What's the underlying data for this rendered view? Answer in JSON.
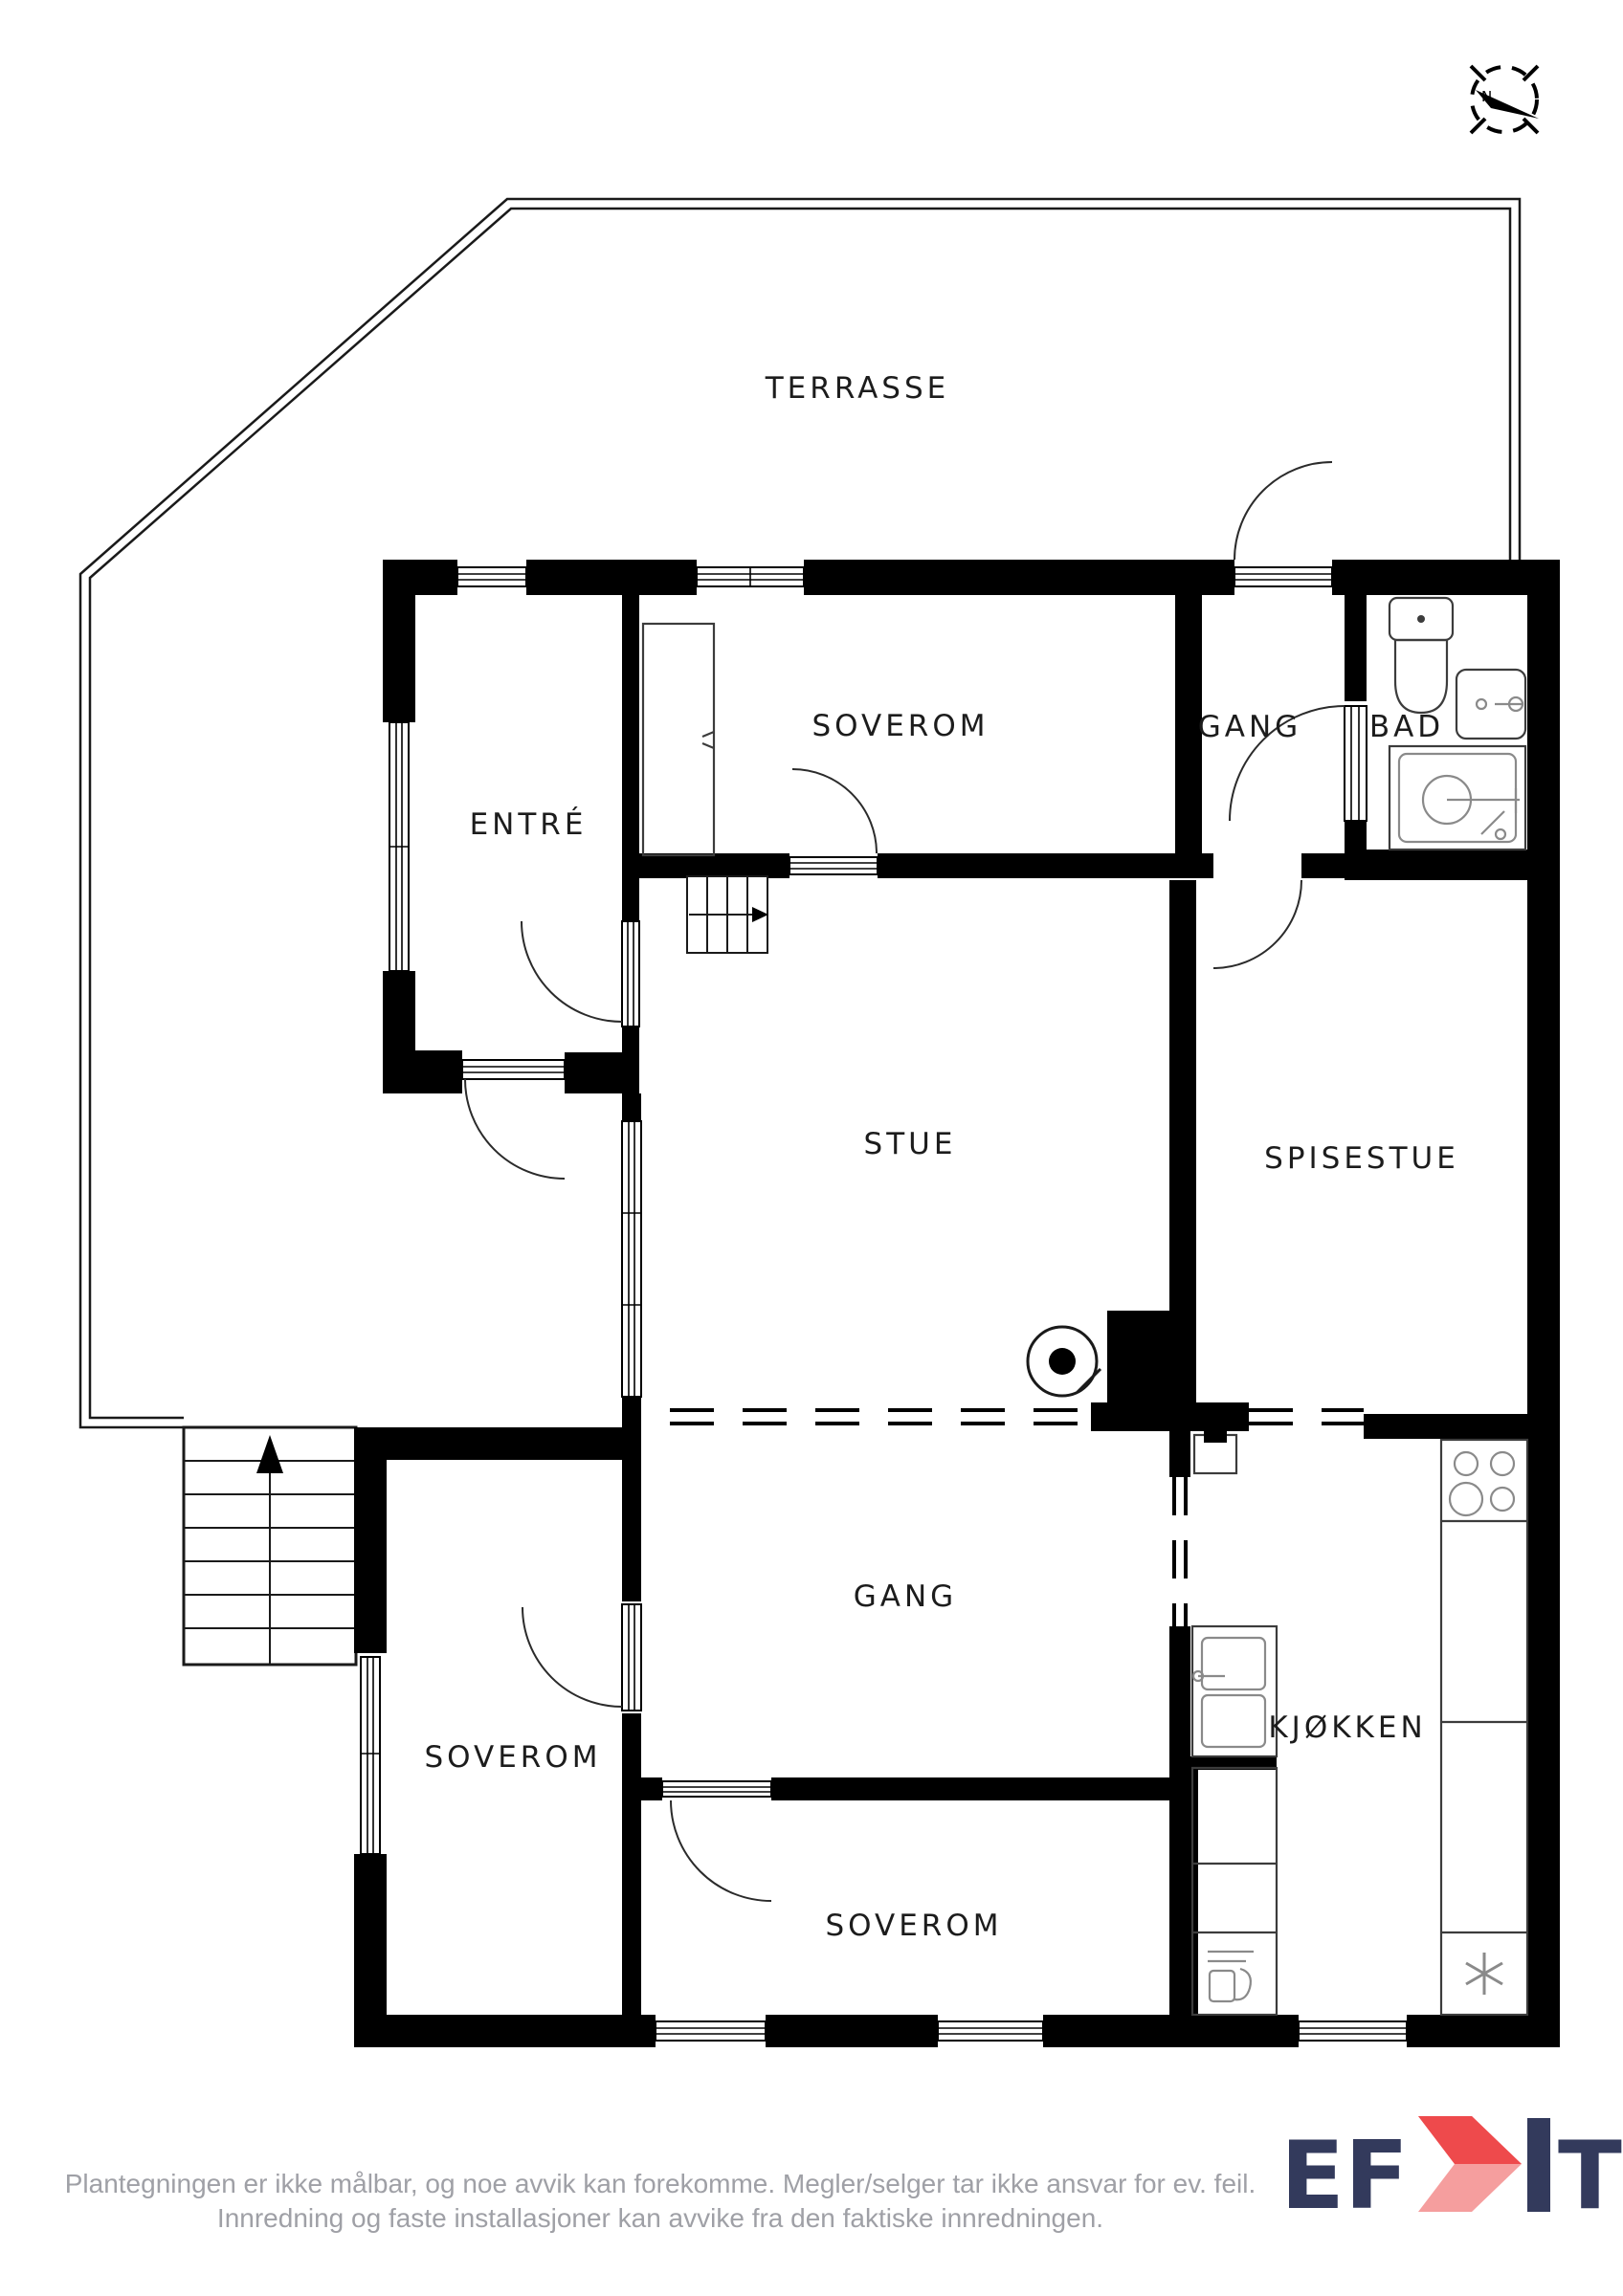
{
  "document_type": "floor-plan",
  "labels": {
    "terrasse": "TERRASSE",
    "soverom_top": "SOVEROM",
    "gang_top": "GANG",
    "bad": "BAD",
    "entre": "ENTRÉ",
    "stue": "STUE",
    "spisestue": "SPISESTUE",
    "gang_bottom": "GANG",
    "kjokken": "KJØKKEN",
    "soverom_left": "SOVEROM",
    "soverom_bottom": "SOVEROM"
  },
  "compass": {
    "north_label": "N"
  },
  "footer": {
    "disclaimer_line1": "Plantegningen er ikke målbar, og noe avvik kan forekomme. Megler/selger tar ikke ansvar for ev. feil.",
    "disclaimer_line2": "Innredning og faste installasjoner kan avvike fra den faktiske innredningen.",
    "logo_ef": "EF",
    "logo_t": "T"
  },
  "colors": {
    "wall": "#000000",
    "label": "#1c1c1c",
    "disclaimer": "#9fa0a6",
    "logo_navy": "#333a5c",
    "logo_red": "#ee4a4c",
    "logo_red_light": "#f59e9e"
  }
}
